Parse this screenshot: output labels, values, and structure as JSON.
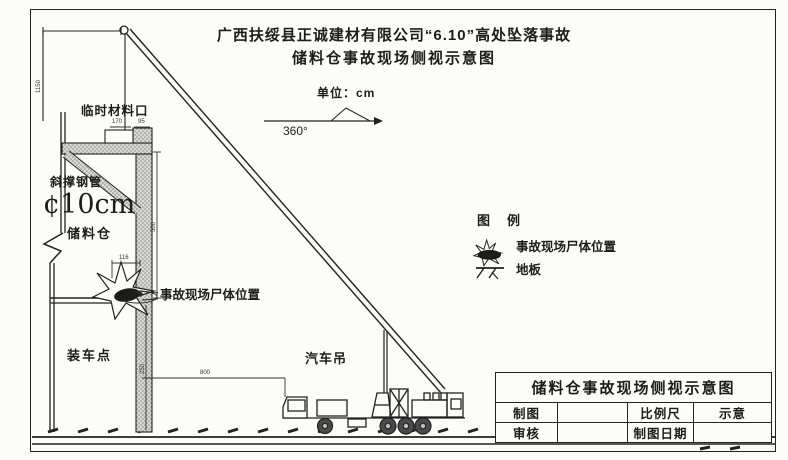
{
  "title": {
    "line1": "广西扶绥县正诚建材有限公司“6.10”高处坠落事故",
    "line2": "储料仓事故现场侧视示意图"
  },
  "annotations": {
    "unit": "单位：cm",
    "angle": "360°",
    "temp_opening": "临时材料口",
    "brace": "斜撑钢管",
    "brace_diameter": "¢10cm",
    "silo": "储料仓",
    "loading_point": "装车点",
    "truck_crane": "汽车吊",
    "body_callout": "事故现场尸体位置"
  },
  "dimensions": {
    "left_height": "1150",
    "opening_w1": "170",
    "opening_w2": "95",
    "body_offset": "116",
    "column_upper": "500",
    "column_lower": "250",
    "ground_span": "800"
  },
  "legend": {
    "title": "图　例",
    "items": [
      {
        "icon": "body-icon",
        "label": "事故现场尸体位置"
      },
      {
        "icon": "floor-icon",
        "label": "地板"
      }
    ]
  },
  "titleblock": {
    "title": "储料仓事故现场侧视示意图",
    "rows": [
      [
        "制图",
        "",
        "比例尺",
        "示意"
      ],
      [
        "审核",
        "",
        "制图日期",
        ""
      ]
    ]
  },
  "colors": {
    "line": "#222222",
    "stipple_fill": "#d8d8d6",
    "stipple_dot": "#8a8a88",
    "body_blob": "#1c1c1c"
  }
}
